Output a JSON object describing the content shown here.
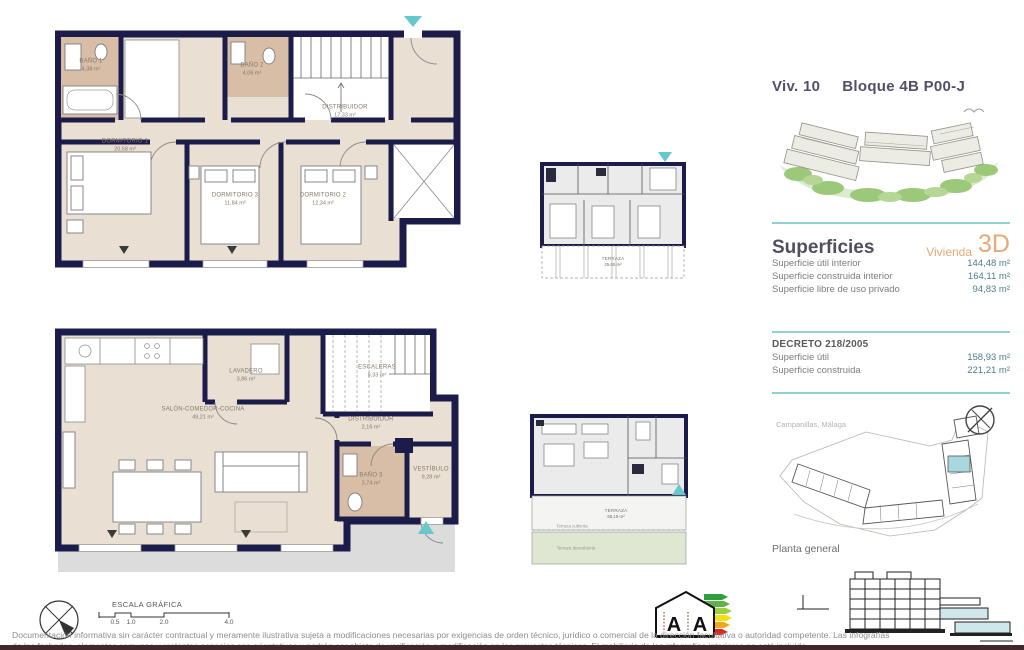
{
  "title": {
    "unit": "Viv. 10",
    "block": "Bloque 4B P00-J"
  },
  "plans": {
    "upper": {
      "rooms": [
        {
          "name": "BAÑO 1",
          "area": "4,38 m²"
        },
        {
          "name": "BAÑO 2",
          "area": "4,06 m²"
        },
        {
          "name": "DISTRIBUIDOR",
          "area": "17,33 m²"
        },
        {
          "name": "DORMITORIO 1",
          "area": "20,58 m²"
        },
        {
          "name": "DORMITORIO 3",
          "area": "11,84 m²"
        },
        {
          "name": "DORMITORIO 2",
          "area": "12,34 m²"
        }
      ]
    },
    "main": {
      "rooms": [
        {
          "name": "LAVADERO",
          "area": "3,86 m²"
        },
        {
          "name": "ESCALERAS",
          "area": "9,33 m²"
        },
        {
          "name": "SALÓN-COMEDOR-COCINA",
          "area": "49,21 m²"
        },
        {
          "name": "DISTRIBUIDOR",
          "area": "2,16 m²"
        },
        {
          "name": "BAÑO 3",
          "area": "3,74 m²"
        },
        {
          "name": "VESTÍBULO",
          "area": "9,28 m²"
        }
      ]
    },
    "key_upper": {
      "terrace": "TERRAZA",
      "terrace_area": "25,65 m²"
    },
    "key_main": {
      "terrace": "TERRAZA",
      "terrace_area": "66,19 m²",
      "covered": "Terraza cubierta",
      "uncovered": "Terraza descubierta"
    }
  },
  "superficies": {
    "heading": "Superficies",
    "tag": "Vivienda",
    "tag_3d": "3D",
    "rows": [
      {
        "label": "Superficie útil interior",
        "value": "144,48 m²"
      },
      {
        "label": "Superficie construida interior",
        "value": "164,11 m²"
      },
      {
        "label": "Superficie libre de uso privado",
        "value": "94,83 m²"
      }
    ]
  },
  "decreto": {
    "heading": "DECRETO 218/2005",
    "rows": [
      {
        "label": "Superficie útil",
        "value": "158,93 m²"
      },
      {
        "label": "Superficie construida",
        "value": "221,21 m²"
      }
    ]
  },
  "site": {
    "location": "Campanillas, Málaga",
    "caption": "Planta general"
  },
  "scale": {
    "title": "ESCALA GRÁFICA",
    "ticks": [
      "0.5",
      "1.0",
      "2.0",
      "4.0"
    ]
  },
  "energy": {
    "letter_consumo": "A",
    "letter_emisiones": "A"
  },
  "disclaimer": {
    "line1": "Documentación informativa sin carácter contractual y meramente ilustrativa sujeta a modificaciones necesarias por exigencias de orden técnico, jurídico o comercial de la dirección facultativa o autoridad competente. Las infografías",
    "line2": "de las fachadas, elementos comunes y restantes espacios son orientativas y podrán ser objeto de verificación o modificación en los proyectos técnicos. El mobiliario de las infografías interiores no está incluido."
  },
  "colors": {
    "wall": "#1c1c4a",
    "floor": "#e9dfd2",
    "bath": "#d8bda7",
    "terrace_gray": "#dcdcdc",
    "green_strip": "#dfe7d2",
    "accent_teal": "#66c7cc",
    "rule_teal": "#8ed2d4",
    "orange": "#e8a877",
    "title": "#50506b"
  }
}
